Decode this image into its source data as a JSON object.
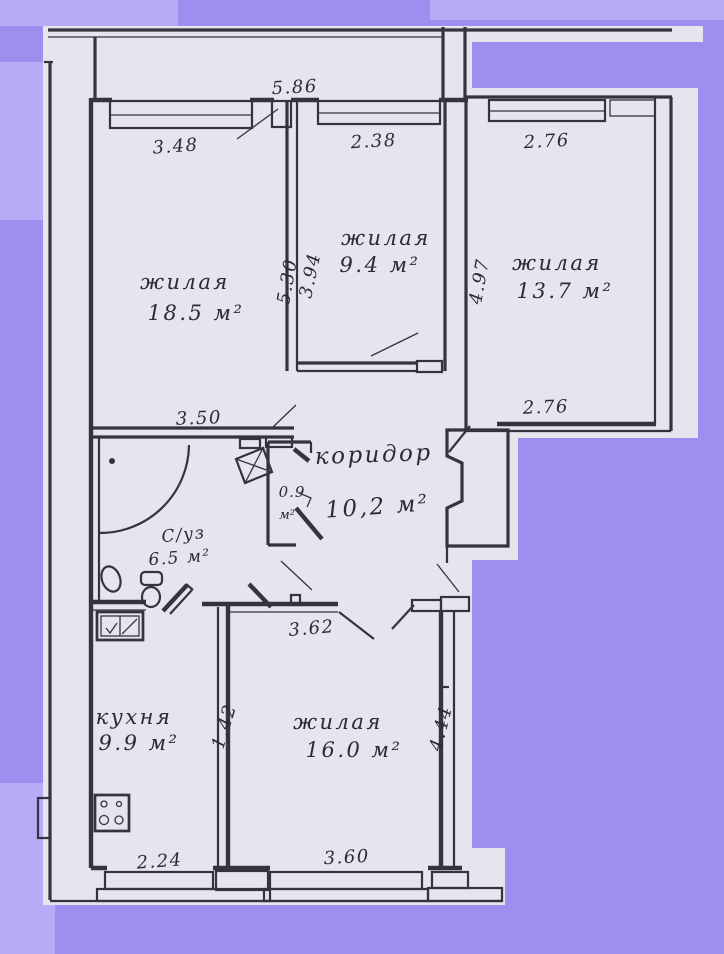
{
  "scan": {
    "colors": {
      "background": "#9d8ff0",
      "background_light": "#b7abf7",
      "paper": "#e5e5ee",
      "ink": "#34343e"
    }
  },
  "plan": {
    "rooms": [
      {
        "id": "living-room-1",
        "label": "жилая",
        "area": "18.5 м²"
      },
      {
        "id": "living-room-2",
        "label": "жилая",
        "area": "9.4 м²"
      },
      {
        "id": "living-room-3",
        "label": "жилая",
        "area": "13.7 м²"
      },
      {
        "id": "corridor",
        "label": "коридор",
        "area": "10,2 м²"
      },
      {
        "id": "bathroom",
        "label": "С/уз",
        "area": "6.5 м²"
      },
      {
        "id": "pantry",
        "label": "0.9",
        "area": "м²"
      },
      {
        "id": "kitchen",
        "label": "кухня",
        "area": "9.9 м²"
      },
      {
        "id": "living-room-4",
        "label": "жилая",
        "area": "16.0 м²"
      }
    ],
    "dimensions": {
      "balcony_width": "5.86",
      "window_living1": "3.48",
      "window_living2": "2.38",
      "window_living3": "2.76",
      "living1_depth": "5.30",
      "living2_depth": "3.94",
      "living3_depth": "4.97",
      "bath_wall": "3.50",
      "living3_bottom": "2.76",
      "living4_top": "3.62",
      "kitchen_wall": "1.42",
      "living4_depth": "4.44",
      "kitchen_window": "2.24",
      "living4_window": "3.60"
    }
  }
}
